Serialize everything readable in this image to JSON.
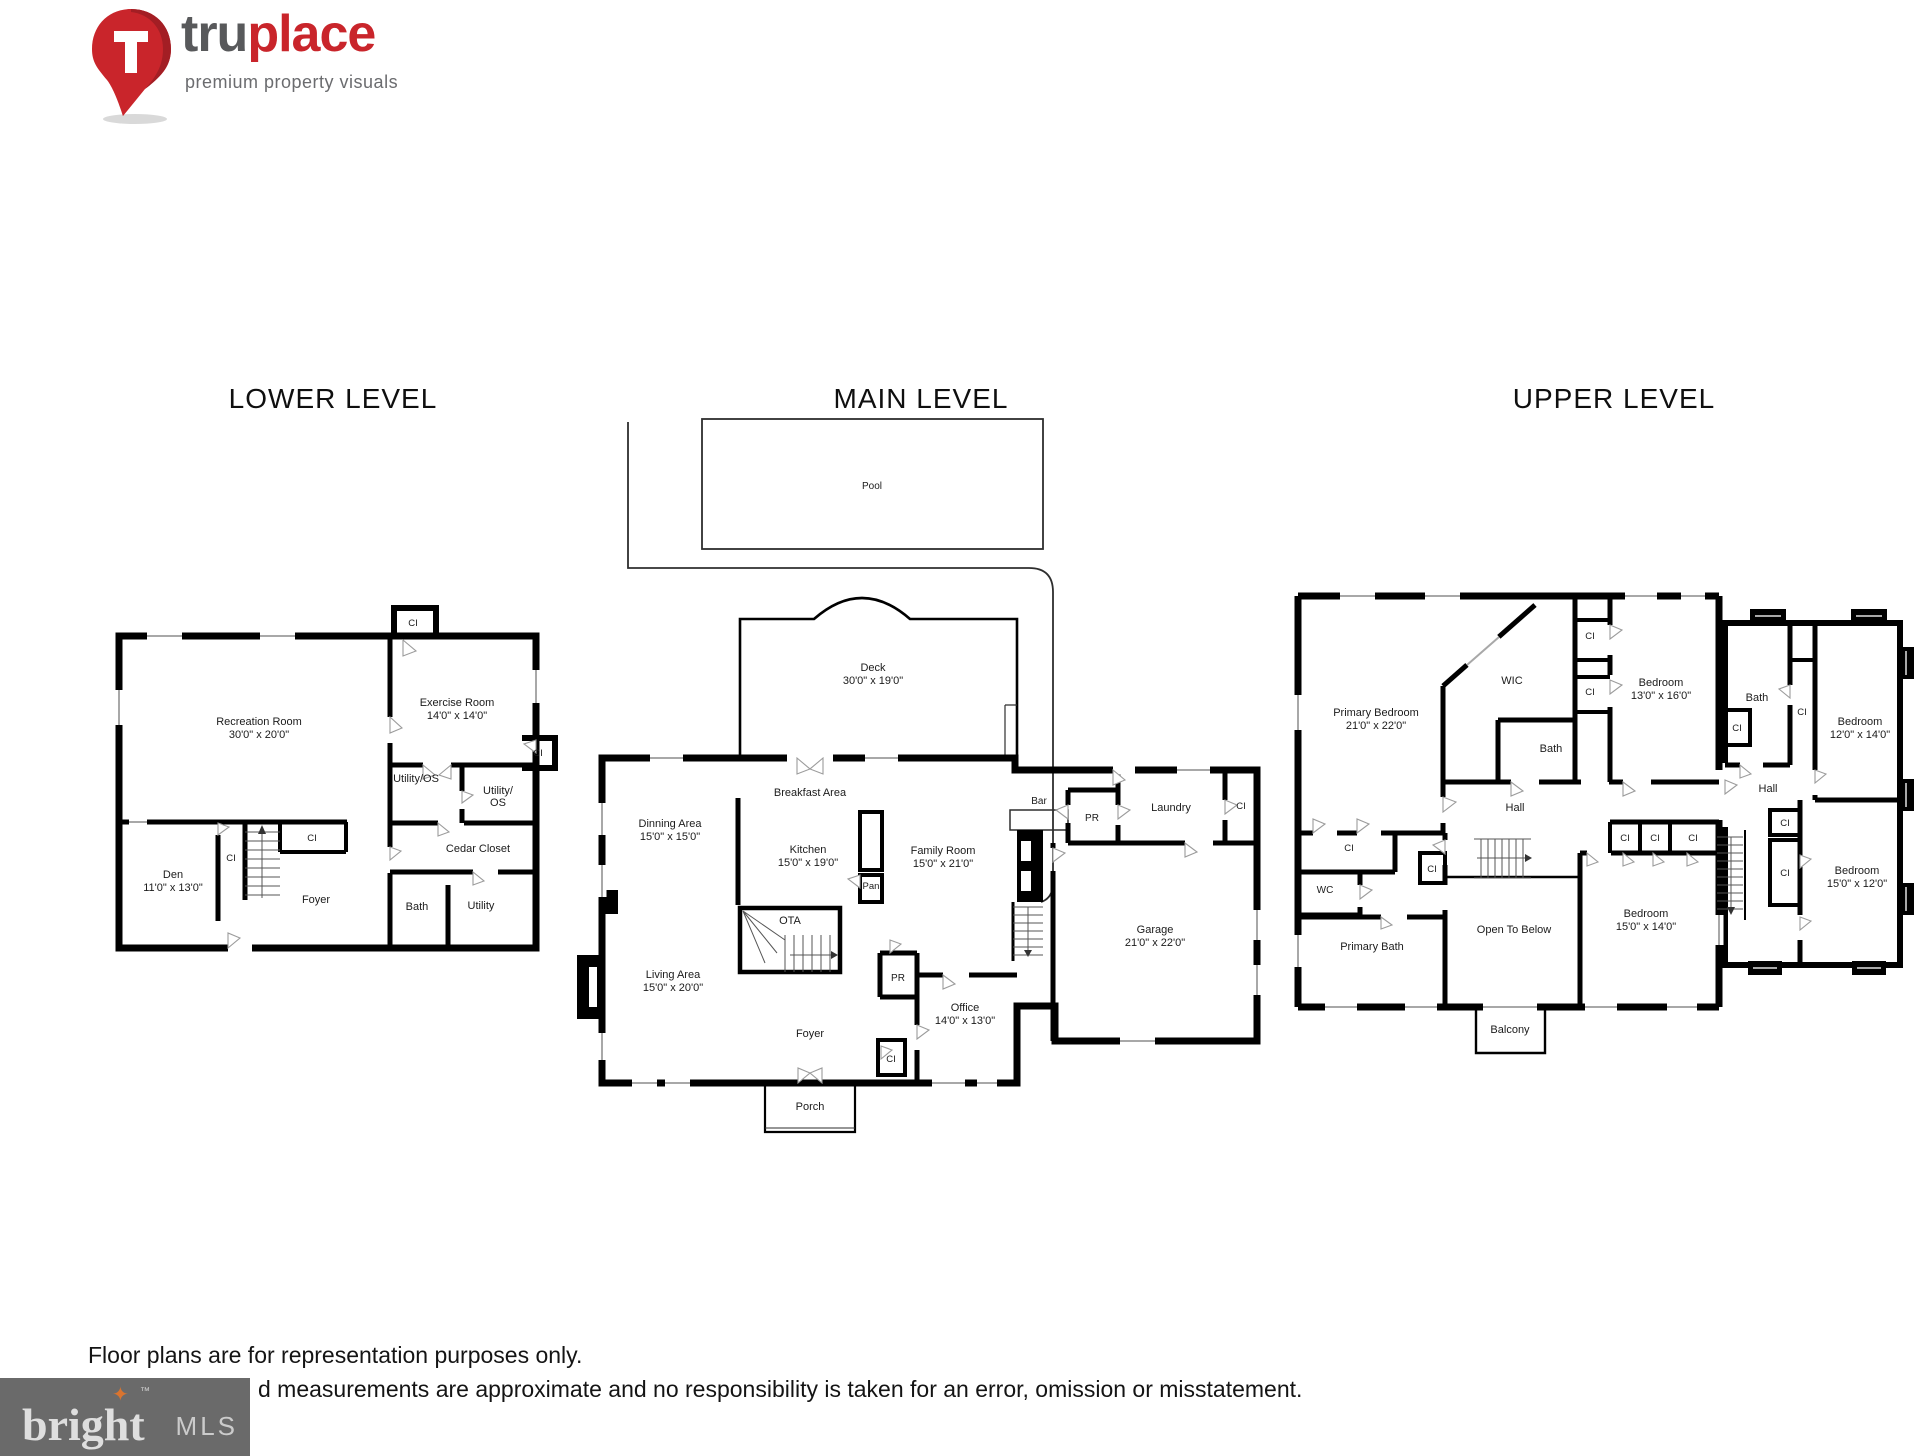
{
  "brand": {
    "logo_tru": "tru",
    "logo_place": "place",
    "tagline": "premium property visuals",
    "pin_letter": "T",
    "colors": {
      "red": "#c9252b",
      "gray": "#58595b"
    }
  },
  "footer": {
    "disclaimer_line1": "Floor plans are for representation purposes only.",
    "disclaimer_line2": "d measurements are approximate and no responsibility is taken for an error, omission or misstatement.",
    "mls": {
      "name": "bright",
      "tm": "™",
      "star": "✦",
      "suffix": "MLS",
      "bg": "#6a6a6a",
      "star_color": "#d9742f"
    }
  },
  "levels": {
    "lower": {
      "title": "LOWER LEVEL",
      "rooms": {
        "recreation": {
          "name": "Recreation Room",
          "dims": "30'0\" x 20'0\""
        },
        "exercise": {
          "name": "Exercise Room",
          "dims": "14'0\" x 14'0\""
        },
        "den": {
          "name": "Den",
          "dims": "11'0\" x 13'0\""
        },
        "foyer": {
          "name": "Foyer"
        },
        "bath": {
          "name": "Bath"
        },
        "utility": {
          "name": "Utility"
        },
        "cedar": {
          "name": "Cedar Closet"
        },
        "utility_os": {
          "name": "Utility/OS"
        },
        "utility_os_l1": "Utility/",
        "utility_os_l2": "OS",
        "ci": "CI"
      }
    },
    "main": {
      "title": "MAIN LEVEL",
      "rooms": {
        "pool": {
          "name": "Pool"
        },
        "deck": {
          "name": "Deck",
          "dims": "30'0\" x 19'0\""
        },
        "breakfast": {
          "name": "Breakfast Area"
        },
        "dinning": {
          "name": "Dinning Area",
          "dims": "15'0\" x 15'0\""
        },
        "kitchen": {
          "name": "Kitchen",
          "dims": "15'0\" x 19'0\""
        },
        "family": {
          "name": "Family Room",
          "dims": "15'0\" x 21'0\""
        },
        "living": {
          "name": "Living Area",
          "dims": "15'0\" x 20'0\""
        },
        "ota": {
          "name": "OTA"
        },
        "pan": {
          "name": "Pan"
        },
        "bar": {
          "name": "Bar"
        },
        "pr": {
          "name": "PR"
        },
        "laundry": {
          "name": "Laundry"
        },
        "garage": {
          "name": "Garage",
          "dims": "21'0\" x 22'0\""
        },
        "office": {
          "name": "Office",
          "dims": "14'0\" x 13'0\""
        },
        "foyer": {
          "name": "Foyer"
        },
        "porch": {
          "name": "Porch"
        },
        "ci": "CI"
      }
    },
    "upper": {
      "title": "UPPER LEVEL",
      "rooms": {
        "primary_bedroom": {
          "name": "Primary Bedroom",
          "dims": "21'0\" x 22'0\""
        },
        "wic": {
          "name": "WIC"
        },
        "bath": {
          "name": "Bath"
        },
        "bedroom_13x16": {
          "name": "Bedroom",
          "dims": "13'0\" x 16'0\""
        },
        "hall": {
          "name": "Hall"
        },
        "wc": {
          "name": "WC"
        },
        "primary_bath": {
          "name": "Primary Bath"
        },
        "open_to_below": {
          "name": "Open To Below"
        },
        "bedroom_15x14": {
          "name": "Bedroom",
          "dims": "15'0\" x 14'0\""
        },
        "balcony": {
          "name": "Balcony"
        },
        "bath2": {
          "name": "Bath"
        },
        "bedroom_12x14": {
          "name": "Bedroom",
          "dims": "12'0\" x 14'0\""
        },
        "hall2": {
          "name": "Hall"
        },
        "bedroom_15x12": {
          "name": "Bedroom",
          "dims": "15'0\" x 12'0\""
        },
        "ci": "CI"
      }
    }
  }
}
